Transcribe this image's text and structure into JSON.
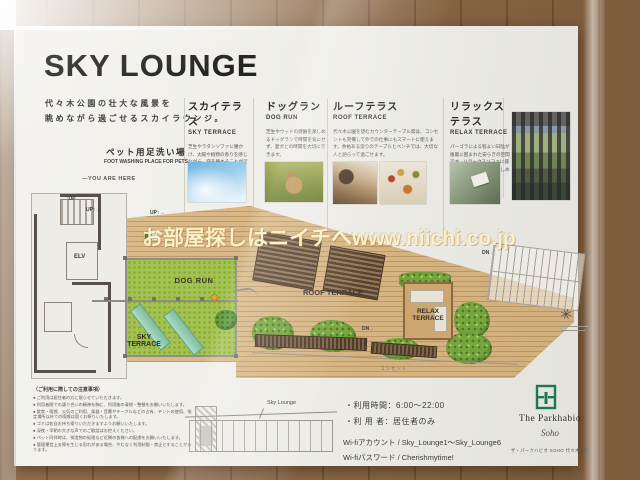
{
  "watermark": {
    "text": "お部屋探しはニイチへwww.niichi.co.jp"
  },
  "board": {
    "title": "SKY LOUNGE",
    "tagline": [
      "代々木公園の壮大な風景を",
      "眺めながら過ごせるスカイラウンジ。"
    ],
    "sections": [
      {
        "jp": "スカイテラス",
        "en": "SKY TERRACE",
        "desc": "芝生やラタンソファに腰かけ、太陽や植物の香りを感じながら、空を眺めることができます。"
      },
      {
        "jp": "ドッグラン",
        "en": "DOG RUN",
        "desc": "芝生やウッドの感触を楽しめるドッグランで時間を気にせず、愛犬との時間を大切にできます。"
      },
      {
        "jp": "ルーフテラス",
        "en": "ROOF TERRACE",
        "desc": "代々木公園を望むカウンターテーブル席は、コンセントも完備して外での仕事にもスマートに使えます。余裕ある造りのテーブルとベンチでは、大切な人と語らって過ごせます。"
      },
      {
        "jp": "リラックステラス",
        "en": "RELAX TERRACE",
        "desc": "パーゴラによる程よい日陰が植栽に囲まれた安らぎの空間です。リラックスソファに座り、少し贅沢な時間を楽しめます。"
      }
    ],
    "map": {
      "foot_wash_jp": "ペット用足洗い場",
      "foot_wash_en": "FOOT WASHING PLACE FOR PETS",
      "you_are_here": "—YOU ARE HERE",
      "up_label_1": "↑UP",
      "up_label_2": "UP↑→",
      "up_label_3": "UP↑→",
      "elevator": "ELV",
      "dog_run": "DOG RUN",
      "sky_terrace_line1": "SKY",
      "sky_terrace_line2": "TERRACE",
      "roof_terrace": "ROOF TERRACE",
      "relax_line1": "RELAX",
      "relax_line2": "TERRACE",
      "dn_label_1": "DN→",
      "dn_label_2": "DN→",
      "outlet": "コンセント"
    },
    "notes": {
      "heading": "（ご利用に際しての注意事項）",
      "lines": [
        "● ご利用は居住者の方に限らせていただきます。",
        "● 利用者間での譲り合いの精神を胸に、利用後の清掃・整頓をお願いいたします。",
        "● 飲食・喫煙、火気のご利用、楽器・音響やテーブルなどの占有、テントの使用、指定場所以外での喫煙は固くお断りいたします。",
        "● ゴミは各自お持ち帰りいただきますようお願いいたします。",
        "● 深夜・早朝の大きな声でのご歓談はお控えください。",
        "● ペット同伴時は、排泄物の処理など近隣の皆様への配慮をお願いいたします。",
        "● 管理運営上支障を生じる恐れがある場合、やむなく利用制限・禁止とすることがあります。"
      ]
    },
    "section_diagram": {
      "label": "Sky Lounge"
    },
    "usage": {
      "hours": "・利用時間：6:00～22:00",
      "users": "・利 用 者：居住者のみ",
      "wifi_account": "Wi-fiアカウント / Sky_Lounge1～Sky_Lounge6",
      "wifi_password": "Wi-fiパスワード / Cherishmytime!"
    },
    "logo": {
      "brand": "The Parkhabio",
      "script": "Soho",
      "caption": "ザ・パークハビオ SOHO 代々木公園"
    }
  },
  "colors": {
    "brand_green": "#1e7a4c",
    "deck_wood": "#d8b884",
    "lawn_green": "#a3c24f",
    "watermark_cream": "#f8f0c8"
  }
}
